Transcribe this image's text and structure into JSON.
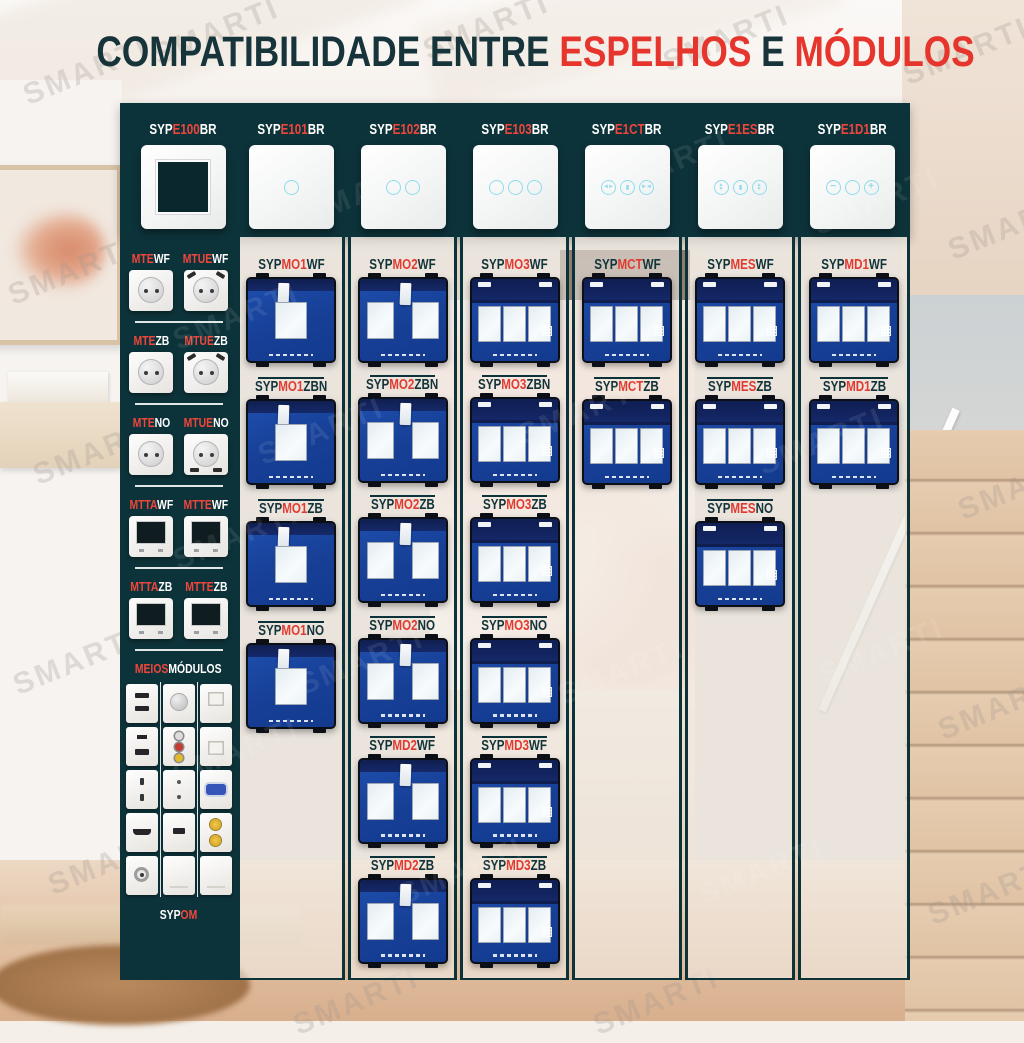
{
  "title": {
    "p1": "COMPATIBILIDADE ENTRE ",
    "p2": "ESPELHOS",
    "p3": " E ",
    "p4": "MÓDULOS"
  },
  "watermark": "SMARTI",
  "colors": {
    "teal": "#0d333a",
    "red": "#e23a2f",
    "red_bright": "#ef463c",
    "cyan": "#8fdcec",
    "panel_strip": "rgba(243,240,235,0.58)"
  },
  "header": {
    "plates": [
      {
        "segs": [
          [
            "SYP",
            0
          ],
          [
            "E100",
            1
          ],
          [
            "BR",
            0
          ]
        ],
        "icon": "empty-frame"
      },
      {
        "segs": [
          [
            "SYP",
            0
          ],
          [
            "E101",
            1
          ],
          [
            "BR",
            0
          ]
        ],
        "icon": "touch-1"
      },
      {
        "segs": [
          [
            "SYP",
            0
          ],
          [
            "E102",
            1
          ],
          [
            "BR",
            0
          ]
        ],
        "icon": "touch-2"
      },
      {
        "segs": [
          [
            "SYP",
            0
          ],
          [
            "E103",
            1
          ],
          [
            "BR",
            0
          ]
        ],
        "icon": "touch-3"
      },
      {
        "segs": [
          [
            "SYP",
            0
          ],
          [
            "E1CT",
            1
          ],
          [
            "BR",
            0
          ]
        ],
        "icon": "curtain-open-stop-close"
      },
      {
        "segs": [
          [
            "SYP",
            0
          ],
          [
            "E1ES",
            1
          ],
          [
            "BR",
            0
          ]
        ],
        "icon": "shutter-up-stop-down"
      },
      {
        "segs": [
          [
            "SYP",
            0
          ],
          [
            "E1D1",
            1
          ],
          [
            "BR",
            0
          ]
        ],
        "icon": "dimmer-minus-plus"
      }
    ]
  },
  "sidebar": {
    "groups": [
      {
        "items": [
          {
            "segs": [
              [
                "MTE",
                1
              ],
              [
                "WF",
                0
              ]
            ],
            "glyph": "socket"
          },
          {
            "segs": [
              [
                "MTUE",
                1
              ],
              [
                "WF",
                0
              ]
            ],
            "glyph": "socket-usb"
          }
        ]
      },
      {
        "items": [
          {
            "segs": [
              [
                "MTE",
                1
              ],
              [
                "ZB",
                0
              ]
            ],
            "glyph": "socket"
          },
          {
            "segs": [
              [
                "MTUE",
                1
              ],
              [
                "ZB",
                0
              ]
            ],
            "glyph": "socket-usb"
          }
        ]
      },
      {
        "items": [
          {
            "segs": [
              [
                "MTE",
                1
              ],
              [
                "NO",
                0
              ]
            ],
            "glyph": "socket"
          },
          {
            "segs": [
              [
                "MTUE",
                1
              ],
              [
                "NO",
                0
              ]
            ],
            "glyph": "socket-usb-b"
          }
        ]
      },
      {
        "items": [
          {
            "segs": [
              [
                "MTTA",
                1
              ],
              [
                "WF",
                0
              ]
            ],
            "glyph": "screen"
          },
          {
            "segs": [
              [
                "MTTE",
                1
              ],
              [
                "WF",
                0
              ]
            ],
            "glyph": "screen"
          }
        ]
      },
      {
        "items": [
          {
            "segs": [
              [
                "MTTA",
                1
              ],
              [
                "ZB",
                0
              ]
            ],
            "glyph": "screen"
          },
          {
            "segs": [
              [
                "MTTE",
                1
              ],
              [
                "ZB",
                0
              ]
            ],
            "glyph": "screen"
          }
        ]
      }
    ],
    "meios": {
      "label_segs": [
        [
          "MEIOS",
          1
        ],
        [
          "MÓDULOS",
          0
        ]
      ],
      "grid": [
        [
          "usb-dual",
          "knob",
          "keystone"
        ],
        [
          "slot-usb",
          "rca",
          "rj45"
        ],
        [
          "two-pin",
          "dots",
          "vga"
        ],
        [
          "hdmi",
          "usb",
          "coax-dual"
        ],
        [
          "tv",
          "blank",
          "blank"
        ]
      ],
      "footer_segs": [
        [
          "SYP",
          0
        ],
        [
          "OM",
          1
        ]
      ]
    }
  },
  "columns": [
    {
      "cells": [
        {
          "segs": [
            [
              "SYP",
              0
            ],
            [
              "MO1",
              1
            ],
            [
              "WF",
              0
            ]
          ],
          "type": "g1"
        },
        {
          "segs": [
            [
              "SYP",
              0
            ],
            [
              "MO1",
              1
            ],
            [
              "ZBN",
              0
            ]
          ],
          "type": "g1"
        },
        {
          "segs": [
            [
              "SYP",
              0
            ],
            [
              "MO1",
              1
            ],
            [
              "ZB",
              0
            ]
          ],
          "type": "g1"
        },
        {
          "segs": [
            [
              "SYP",
              0
            ],
            [
              "MO1",
              1
            ],
            [
              "NO",
              0
            ]
          ],
          "type": "g1"
        }
      ]
    },
    {
      "cells": [
        {
          "segs": [
            [
              "SYP",
              0
            ],
            [
              "MO2",
              1
            ],
            [
              "WF",
              0
            ]
          ],
          "type": "g2"
        },
        {
          "segs": [
            [
              "SYP",
              0
            ],
            [
              "MO2",
              1
            ],
            [
              "ZBN",
              0
            ]
          ],
          "type": "g2"
        },
        {
          "segs": [
            [
              "SYP",
              0
            ],
            [
              "MO2",
              1
            ],
            [
              "ZB",
              0
            ]
          ],
          "type": "g2"
        },
        {
          "segs": [
            [
              "SYP",
              0
            ],
            [
              "MO2",
              1
            ],
            [
              "NO",
              0
            ]
          ],
          "type": "g2"
        },
        {
          "segs": [
            [
              "SYP",
              0
            ],
            [
              "MD2",
              1
            ],
            [
              "WF",
              0
            ]
          ],
          "type": "g2"
        },
        {
          "segs": [
            [
              "SYP",
              0
            ],
            [
              "MD2",
              1
            ],
            [
              "ZB",
              0
            ]
          ],
          "type": "g2"
        }
      ]
    },
    {
      "cells": [
        {
          "segs": [
            [
              "SYP",
              0
            ],
            [
              "MO3",
              1
            ],
            [
              "WF",
              0
            ]
          ],
          "type": "g3"
        },
        {
          "segs": [
            [
              "SYP",
              0
            ],
            [
              "MO3",
              1
            ],
            [
              "ZBN",
              0
            ]
          ],
          "type": "g3"
        },
        {
          "segs": [
            [
              "SYP",
              0
            ],
            [
              "MO3",
              1
            ],
            [
              "ZB",
              0
            ]
          ],
          "type": "g3"
        },
        {
          "segs": [
            [
              "SYP",
              0
            ],
            [
              "MO3",
              1
            ],
            [
              "NO",
              0
            ]
          ],
          "type": "g3"
        },
        {
          "segs": [
            [
              "SYP",
              0
            ],
            [
              "MD3",
              1
            ],
            [
              "WF",
              0
            ]
          ],
          "type": "g3"
        },
        {
          "segs": [
            [
              "SYP",
              0
            ],
            [
              "MD3",
              1
            ],
            [
              "ZB",
              0
            ]
          ],
          "type": "g3"
        }
      ]
    },
    {
      "cells": [
        {
          "segs": [
            [
              "SYP",
              0
            ],
            [
              "MCT",
              1
            ],
            [
              "WF",
              0
            ]
          ],
          "type": "g3"
        },
        {
          "segs": [
            [
              "SYP",
              0
            ],
            [
              "MCT",
              1
            ],
            [
              "ZB",
              0
            ]
          ],
          "type": "g3"
        }
      ]
    },
    {
      "cells": [
        {
          "segs": [
            [
              "SYP",
              0
            ],
            [
              "MES",
              1
            ],
            [
              "WF",
              0
            ]
          ],
          "type": "g3"
        },
        {
          "segs": [
            [
              "SYP",
              0
            ],
            [
              "MES",
              1
            ],
            [
              "ZB",
              0
            ]
          ],
          "type": "g3"
        },
        {
          "segs": [
            [
              "SYP",
              0
            ],
            [
              "MES",
              1
            ],
            [
              "NO",
              0
            ]
          ],
          "type": "g3"
        }
      ]
    },
    {
      "cells": [
        {
          "segs": [
            [
              "SYP",
              0
            ],
            [
              "MD1",
              1
            ],
            [
              "WF",
              0
            ]
          ],
          "type": "g3"
        },
        {
          "segs": [
            [
              "SYP",
              0
            ],
            [
              "MD1",
              1
            ],
            [
              "ZB",
              0
            ]
          ],
          "type": "g3"
        }
      ]
    }
  ]
}
